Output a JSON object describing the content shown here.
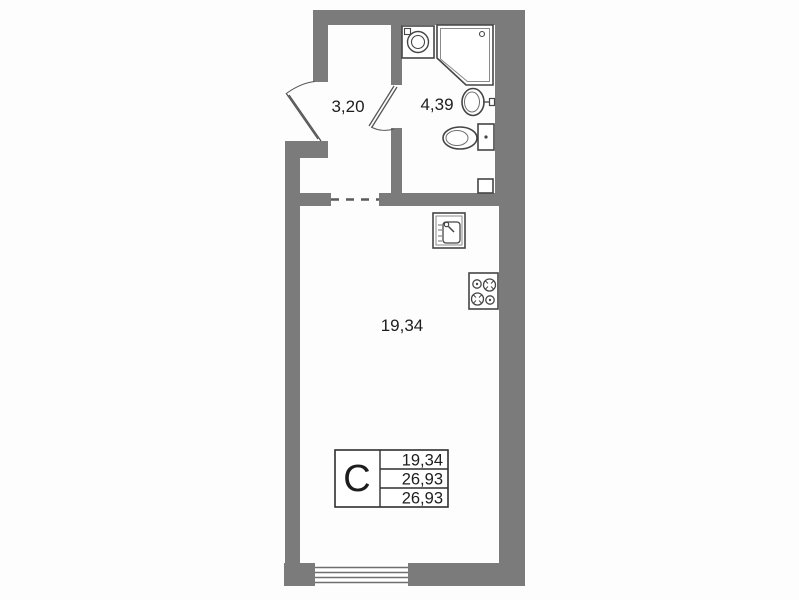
{
  "plan": {
    "kind": "studio-apartment-floor-plan",
    "rooms": {
      "hallway": {
        "area": "3,20"
      },
      "bathroom": {
        "area": "4,39"
      },
      "living_room": {
        "area": "19,34"
      }
    },
    "legend": {
      "type": "С",
      "rows": [
        "19,34",
        "26,93",
        "26,93"
      ]
    },
    "fixtures": [
      "washing-machine",
      "shower-cabin",
      "washbasin",
      "toilet",
      "kitchen-sink",
      "stove-4-burners",
      "window",
      "entry-door",
      "bathroom-door",
      "dashed-passage",
      "vent-duct"
    ],
    "colors": {
      "wall": "#7b7b7b",
      "fixture_line": "#454545",
      "light_line": "#8a8a8a",
      "text": "#1d1d1d",
      "background": "#fdfdfd"
    }
  }
}
